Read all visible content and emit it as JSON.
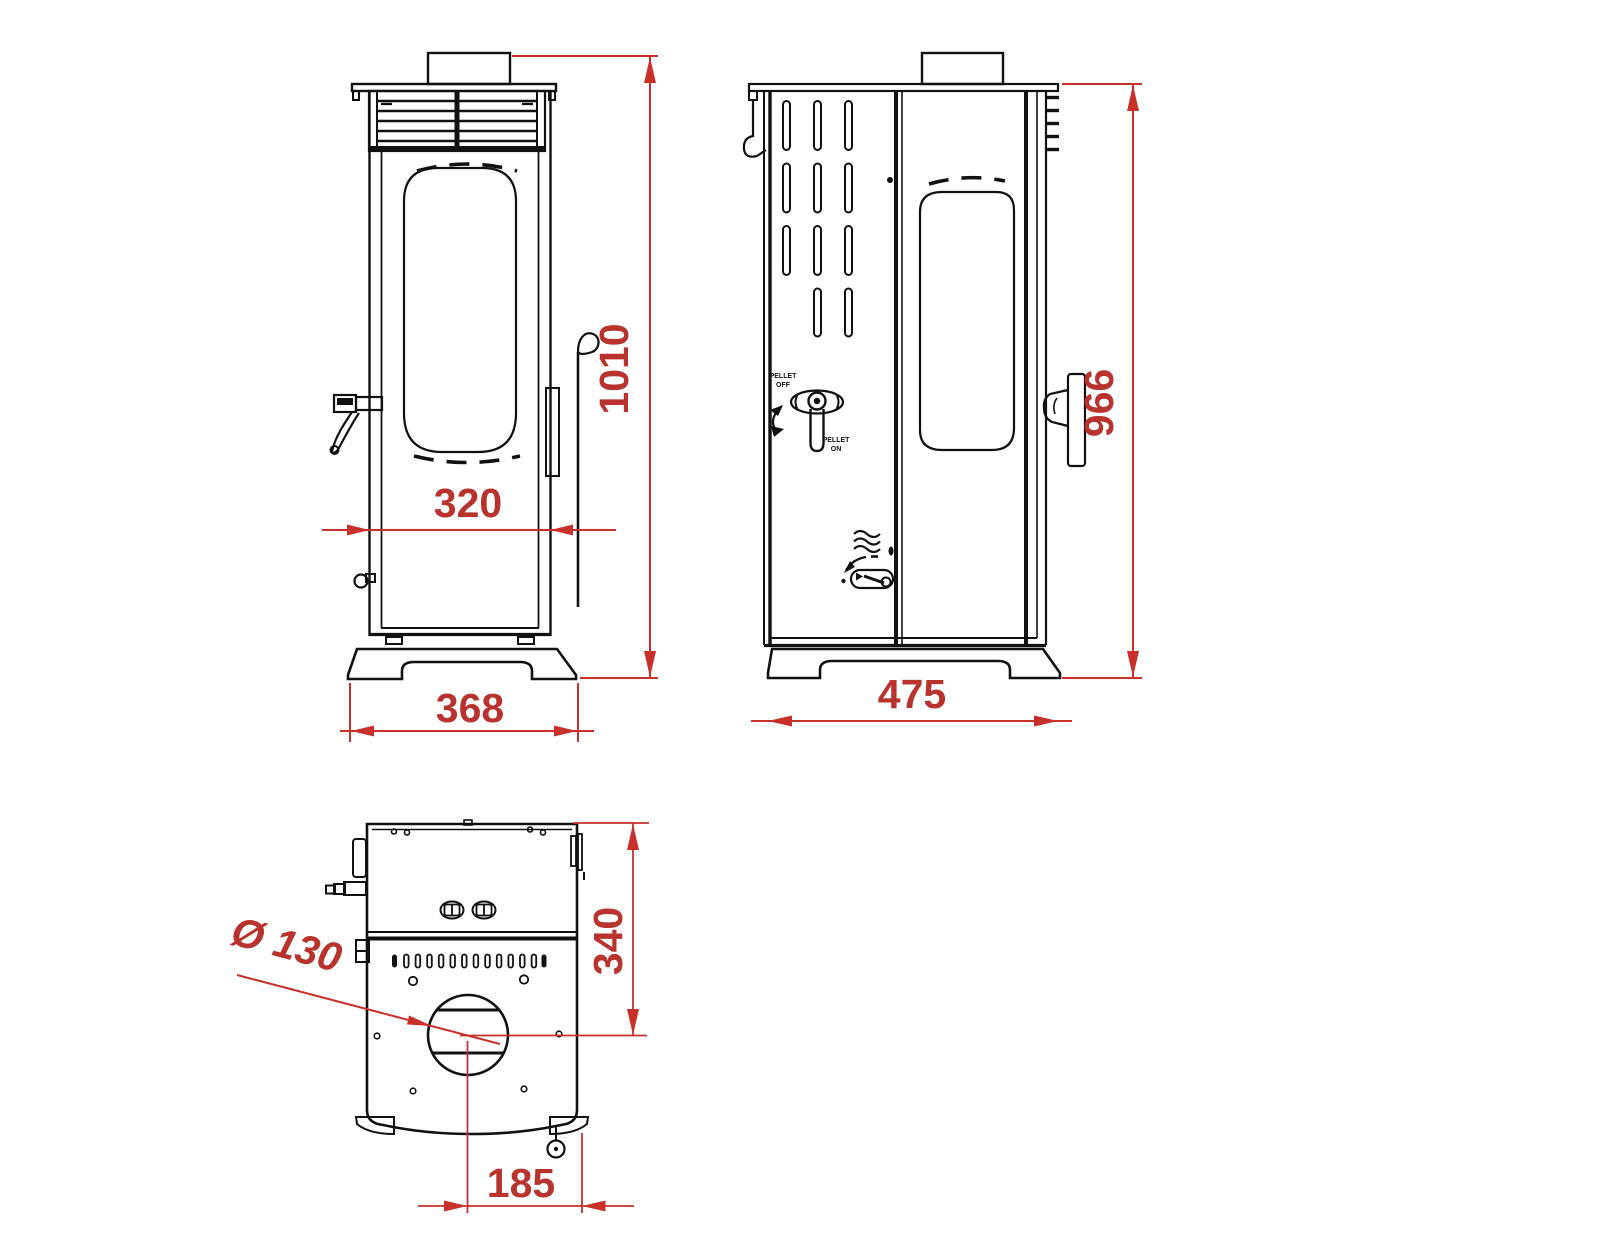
{
  "drawing": {
    "type": "pellet-stove-technical-drawing",
    "colors": {
      "linework": "#111111",
      "dimension": "#c8302a",
      "background": "#ffffff"
    }
  },
  "views": {
    "front": {
      "dims": {
        "glass_width": "320",
        "base_width": "368",
        "total_height": "1010"
      }
    },
    "side": {
      "dims": {
        "base_depth": "475",
        "body_height": "966"
      },
      "labels": {
        "pellet_off": [
          "PELLET",
          "OFF"
        ],
        "pellet_on": [
          "PELLET",
          "ON"
        ]
      }
    },
    "top": {
      "dims": {
        "flue_diameter": "Ø 130",
        "back_to_flue_center": "340",
        "flue_center_to_side": "185"
      }
    }
  }
}
